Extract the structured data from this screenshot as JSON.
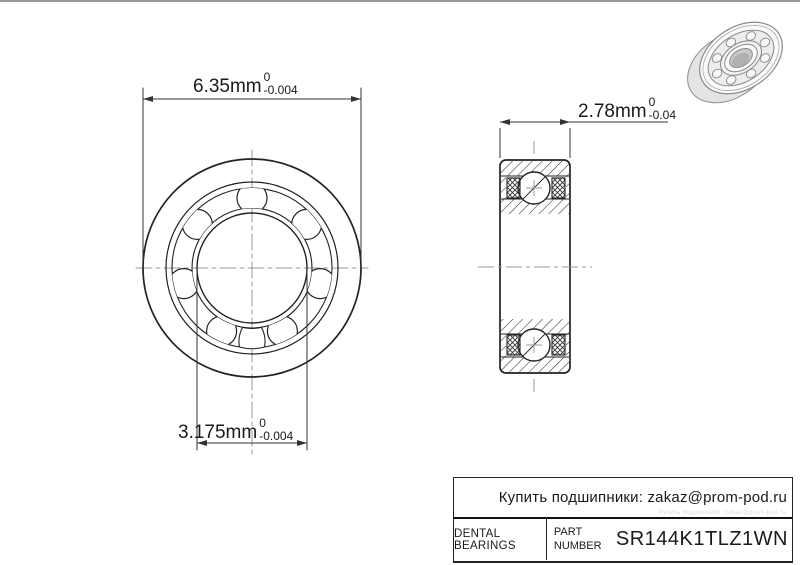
{
  "colors": {
    "line": "#222222",
    "dimension_line": "#333333",
    "centerline": "#999999",
    "text": "#1a1a1a",
    "render_shade": "#ececec"
  },
  "dimensions": {
    "outer_diameter": {
      "value": "6.35mm",
      "tol_upper": "0",
      "tol_lower": "-0.004"
    },
    "width": {
      "value": "2.78mm",
      "tol_upper": "0",
      "tol_lower": "-0.04"
    },
    "bore": {
      "value": "3.175mm",
      "tol_upper": "0",
      "tol_lower": "-0.004"
    }
  },
  "title_block": {
    "contact": "Купить подшипники: zakaz@prom-pod.ru",
    "brand": "DENTAL BEARINGS",
    "part_label": "PART NUMBER",
    "part_number": "SR144K1TLZ1WN"
  }
}
